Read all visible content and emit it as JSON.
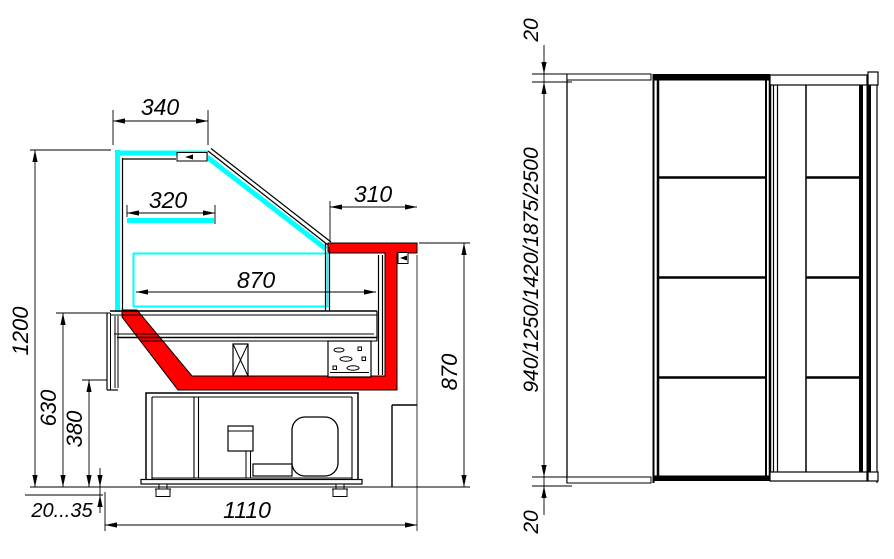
{
  "side_view": {
    "dims": {
      "top_overhang": "340",
      "shelf_depth": "320",
      "front_overhang": "310",
      "display_depth": "870",
      "overall_height": "1200",
      "worktop_height": "630",
      "basin_height": "380",
      "foot_range": "20...35",
      "overall_depth": "1110",
      "front_height": "870"
    }
  },
  "front_view": {
    "dims": {
      "canopy_thickness": "20",
      "length_options": "940/1250/1420/1875/2500",
      "base_gap": "20"
    }
  },
  "colors": {
    "glass": "#00ffff",
    "basin_highlight": "#ff0000",
    "line": "#000000",
    "background": "#ffffff"
  }
}
